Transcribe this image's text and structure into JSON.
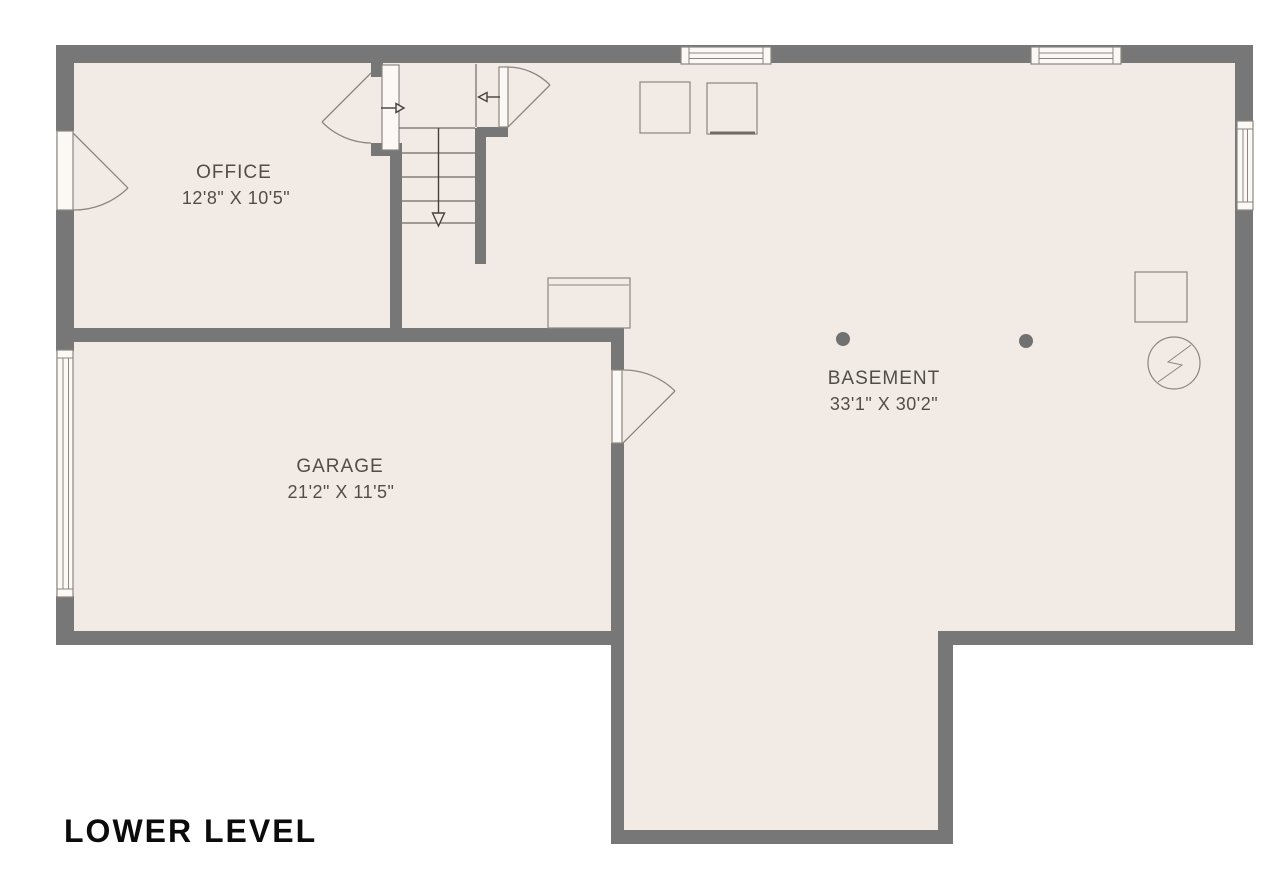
{
  "title": "LOWER LEVEL",
  "rooms": {
    "office": {
      "name": "OFFICE",
      "dimensions": "12'8\" X 10'5\""
    },
    "garage": {
      "name": "GARAGE",
      "dimensions": "21'2\" X 11'5\""
    },
    "basement": {
      "name": "BASEMENT",
      "dimensions": "33'1\" X 30'2\""
    }
  },
  "symbols": {
    "electrical_meter_icon": "circle-lightning-bolt",
    "stair_direction": "down",
    "support_posts_count": 2,
    "windows_count": 4,
    "doors_count": 4
  },
  "colors": {
    "wall": "#777777",
    "floor": "#F2EBE5",
    "outline": "#8B8681",
    "text": "#514E4A",
    "title_text": "#0B0B0B"
  }
}
